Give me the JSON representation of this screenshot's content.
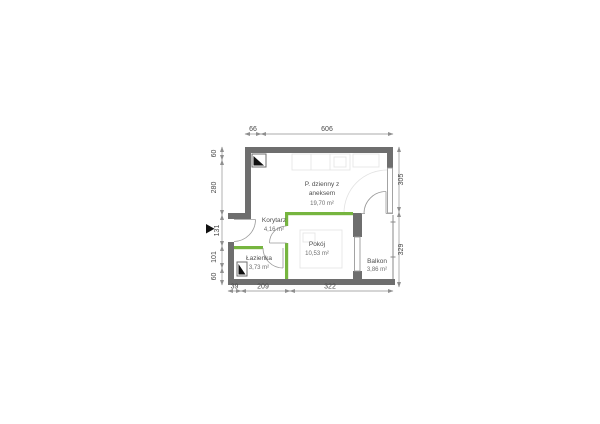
{
  "plan": {
    "rooms": {
      "living": {
        "name_line1": "P. dzienny z",
        "name_line2": "aneksem",
        "area": "19,70 m²"
      },
      "corridor": {
        "name": "Korytarz",
        "area": "4,16 m²"
      },
      "bedroom": {
        "name": "Pokój",
        "area": "10,53 m²"
      },
      "bathroom": {
        "name": "Łazienka",
        "area": "3,73 m²"
      },
      "balcony": {
        "name": "Balkon",
        "area": "3,86 m²"
      }
    },
    "dimensions_cm": {
      "top": [
        "66",
        "606"
      ],
      "left": [
        "60",
        "280",
        "131",
        "101",
        "60"
      ],
      "right": [
        "305",
        "329"
      ],
      "bottom": [
        "39",
        "209",
        "322"
      ]
    },
    "icons": {
      "entrance_marker": "entrance-arrow",
      "shafts": "ventilation-shaft"
    },
    "colors": {
      "wall_gray": "#6e6e6e",
      "partition_green": "#76b53f",
      "dimension_gray": "#8f8f8f",
      "marker_black": "#111111"
    }
  }
}
